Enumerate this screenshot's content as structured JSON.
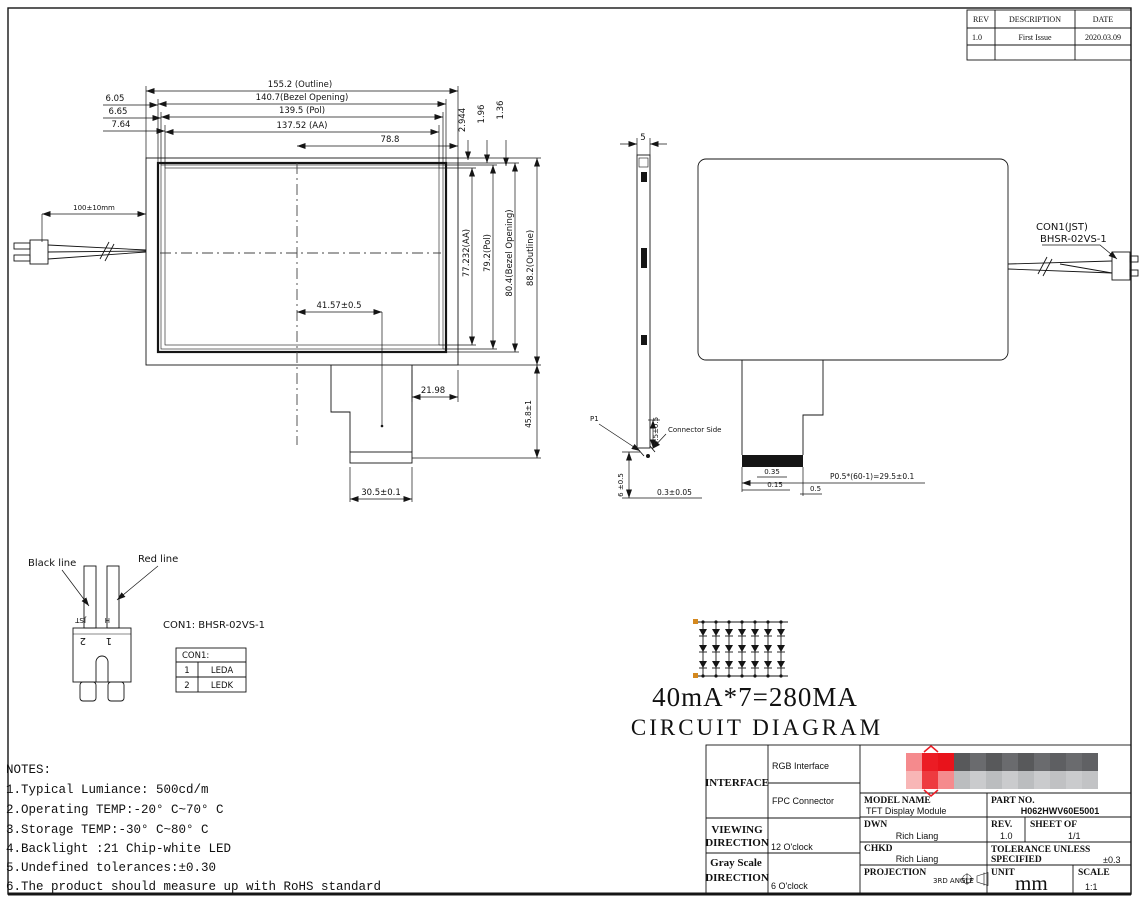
{
  "rev_table": {
    "headers": [
      "REV",
      "DESCRIPTION",
      "DATE"
    ],
    "rows": [
      [
        "1.0",
        "First Issue",
        "2020.03.09"
      ]
    ]
  },
  "front_view": {
    "dim_outline_w": "155.2 (Outline)",
    "dim_bezel_w": "140.7(Bezel Opening)",
    "dim_pol_w": "139.5 (Pol)",
    "dim_aa_w": "137.52 (AA)",
    "dim_half_w": "78.8",
    "dim_left_1": "6.05",
    "dim_left_2": "6.65",
    "dim_left_3": "7.64",
    "dim_top_1": "2.944",
    "dim_top_2": "1.96",
    "dim_top_3": "1.36",
    "dim_aa_h": "77.232(AA)",
    "dim_pol_h": "79.2(Pol)",
    "dim_bezel_h": "80.4(Bezel Opening)",
    "dim_outline_h": "88.2(Outline)",
    "dim_tail_h": "45.8±1",
    "dim_cable": "100±10mm",
    "dim_tail_offset": "41.57±0.5",
    "dim_tail_right": "21.98",
    "dim_fpc_w": "30.5±0.1"
  },
  "side_view": {
    "dim_thickness": "5",
    "label_p1": "P1",
    "label_connector_side": "Connector Side",
    "dim_tip": "3.5±0.5",
    "dim_bottom": "6 ±0.5",
    "dim_gap": "0.3±0.05"
  },
  "rear_view": {
    "con1_line1": "CON1(JST)",
    "con1_line2": "BHSR-02VS-1",
    "dim_a": "0.35",
    "dim_b": "0.15",
    "dim_c": "0.5",
    "dim_pitch": "P0.5*(60-1)=29.5±0.1"
  },
  "connector_detail": {
    "black_line": "Black line",
    "red_line": "Red line",
    "title": "CON1: BHSR-02VS-1",
    "pin_marks": {
      "jst": "JST",
      "h": "H",
      "p2": "2",
      "p1": "1"
    },
    "table": {
      "header": "CON1:",
      "rows": [
        [
          "1",
          "LEDA"
        ],
        [
          "2",
          "LEDK"
        ]
      ]
    }
  },
  "circuit": {
    "branches": 7,
    "leds_per_branch": 3,
    "current_label": "40mA*7=280MA",
    "title": "CIRCUIT DIAGRAM"
  },
  "notes": {
    "title": "NOTES:",
    "items": [
      "1.Typical Lumiance: 500cd/m",
      "2.Operating TEMP:-20° C~70° C",
      "3.Storage TEMP:-30° C~80° C",
      "4.Backlight :21 Chip-white LED",
      "5.Undefined tolerances:±0.30",
      "6.The product should measure up with RoHS standard"
    ]
  },
  "title_block": {
    "interface_label": "INTERFACE",
    "interface_row1": "RGB Interface",
    "interface_row2": "FPC Connector",
    "viewing_label1": "VIEWING",
    "viewing_label2": "DIRECTION",
    "viewing_value": "12 O'clock",
    "gray_label1": "Gray Scale",
    "gray_label2": "DIRECTION",
    "gray_value": "6 O'clock",
    "model_name_label": "MODEL NAME",
    "model_name_value": "TFT Display Module",
    "part_no_label": "PART NO.",
    "part_no_value": "H062HWV60E5001",
    "dwn_label": "DWN",
    "dwn_value": "Rich Liang",
    "rev_label": "REV.",
    "rev_value": "1.0",
    "sheet_label": "SHEET OF",
    "sheet_value": "1/1",
    "chkd_label": "CHKD",
    "chkd_value": "Rich Liang",
    "tol_label1": "TOLERANCE UNLESS",
    "tol_label2": "SPECIFIED",
    "tol_value": "±0.3",
    "proj_label": "PROJECTION",
    "proj_value": "3RD ANGLE",
    "unit_label": "UNIT",
    "unit_value": "mm",
    "scale_label": "SCALE",
    "scale_value": "1:1",
    "logo_colors": {
      "accent": "#ec1c24",
      "rows": [
        [
          "#f58a8d",
          "#ec1c24",
          "#e8131b",
          "#58595b",
          "#6a6b6e",
          "#58595b",
          "#6a6b6e",
          "#58595b",
          "#6a6b6e",
          "#5e5f62",
          "#6a6b6e",
          "#606164"
        ],
        [
          "#f8b6b6",
          "#ee3b40",
          "#f58a8d",
          "#bbbdbf",
          "#cacbcd",
          "#bbbdbf",
          "#cacbcd",
          "#bbbdbf",
          "#cacbcd",
          "#c0c1c3",
          "#cacbcd",
          "#c2c3c5"
        ]
      ]
    }
  }
}
